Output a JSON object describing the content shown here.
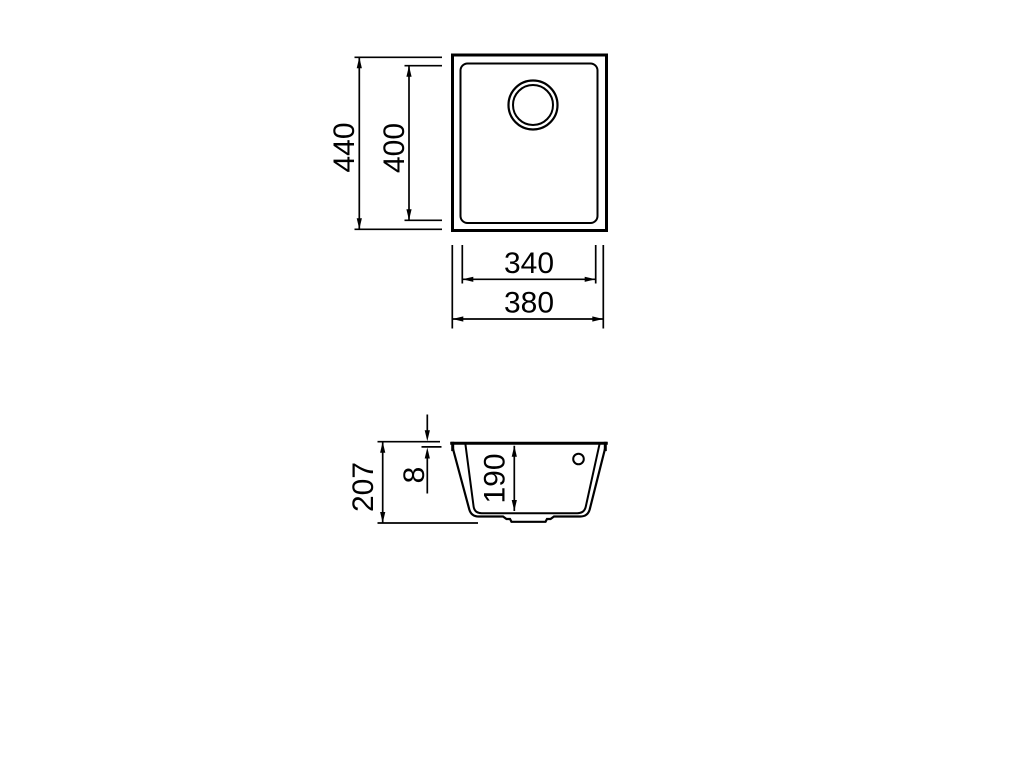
{
  "colors": {
    "background": "#ffffff",
    "line": "#000000"
  },
  "top_view": {
    "outer_height": "440",
    "inner_height": "400",
    "inner_width": "340",
    "outer_width": "380"
  },
  "section_view": {
    "total_depth": "207",
    "rim_thickness": "8",
    "bowl_depth": "190"
  }
}
